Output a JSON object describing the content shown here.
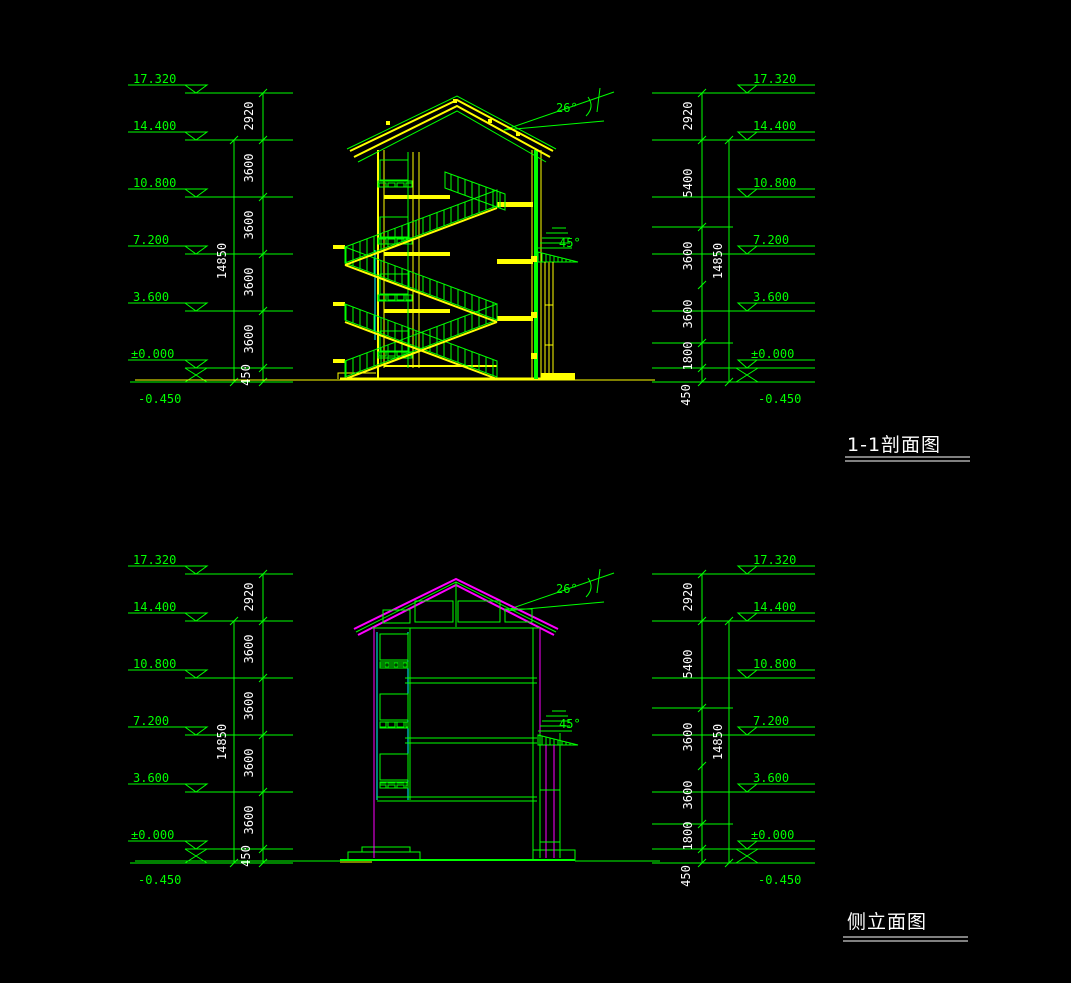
{
  "canvas": {
    "width": 1071,
    "height": 983,
    "background": "#000000"
  },
  "colors": {
    "dimension_lines": "#00FF00",
    "section_structure": "#FFFF00",
    "elevation_outline": "#FF00FF",
    "detail_lines": "#00FFFF",
    "dimension_text": "#FFFFFF",
    "title_text": "#FFFFFF"
  },
  "drawings": [
    {
      "title": "1-1剖面图",
      "levels_left": [
        "17.320",
        "14.400",
        "10.800",
        "7.200",
        "3.600",
        "±0.000",
        "-0.450"
      ],
      "levels_right": [
        "17.320",
        "14.400",
        "10.800",
        "7.200",
        "3.600",
        "±0.000",
        "-0.450"
      ],
      "dims_left": [
        "2920",
        "3600",
        "3600",
        "3600",
        "3600",
        "450"
      ],
      "total_left": "14850",
      "dims_right": [
        "2920",
        "5400",
        "3600",
        "3600",
        "1800",
        "450"
      ],
      "total_right": "14850",
      "roof_angle": "26°",
      "canopy_angle": "45°"
    },
    {
      "title": "侧立面图",
      "levels_left": [
        "17.320",
        "14.400",
        "10.800",
        "7.200",
        "3.600",
        "±0.000",
        "-0.450"
      ],
      "levels_right": [
        "17.320",
        "14.400",
        "10.800",
        "7.200",
        "3.600",
        "±0.000",
        "-0.450"
      ],
      "dims_left": [
        "2920",
        "3600",
        "3600",
        "3600",
        "3600",
        "450"
      ],
      "total_left": "14850",
      "dims_right": [
        "2920",
        "5400",
        "3600",
        "3600",
        "1800",
        "450"
      ],
      "total_right": "14850",
      "roof_angle": "26°",
      "canopy_angle": "45°"
    }
  ]
}
